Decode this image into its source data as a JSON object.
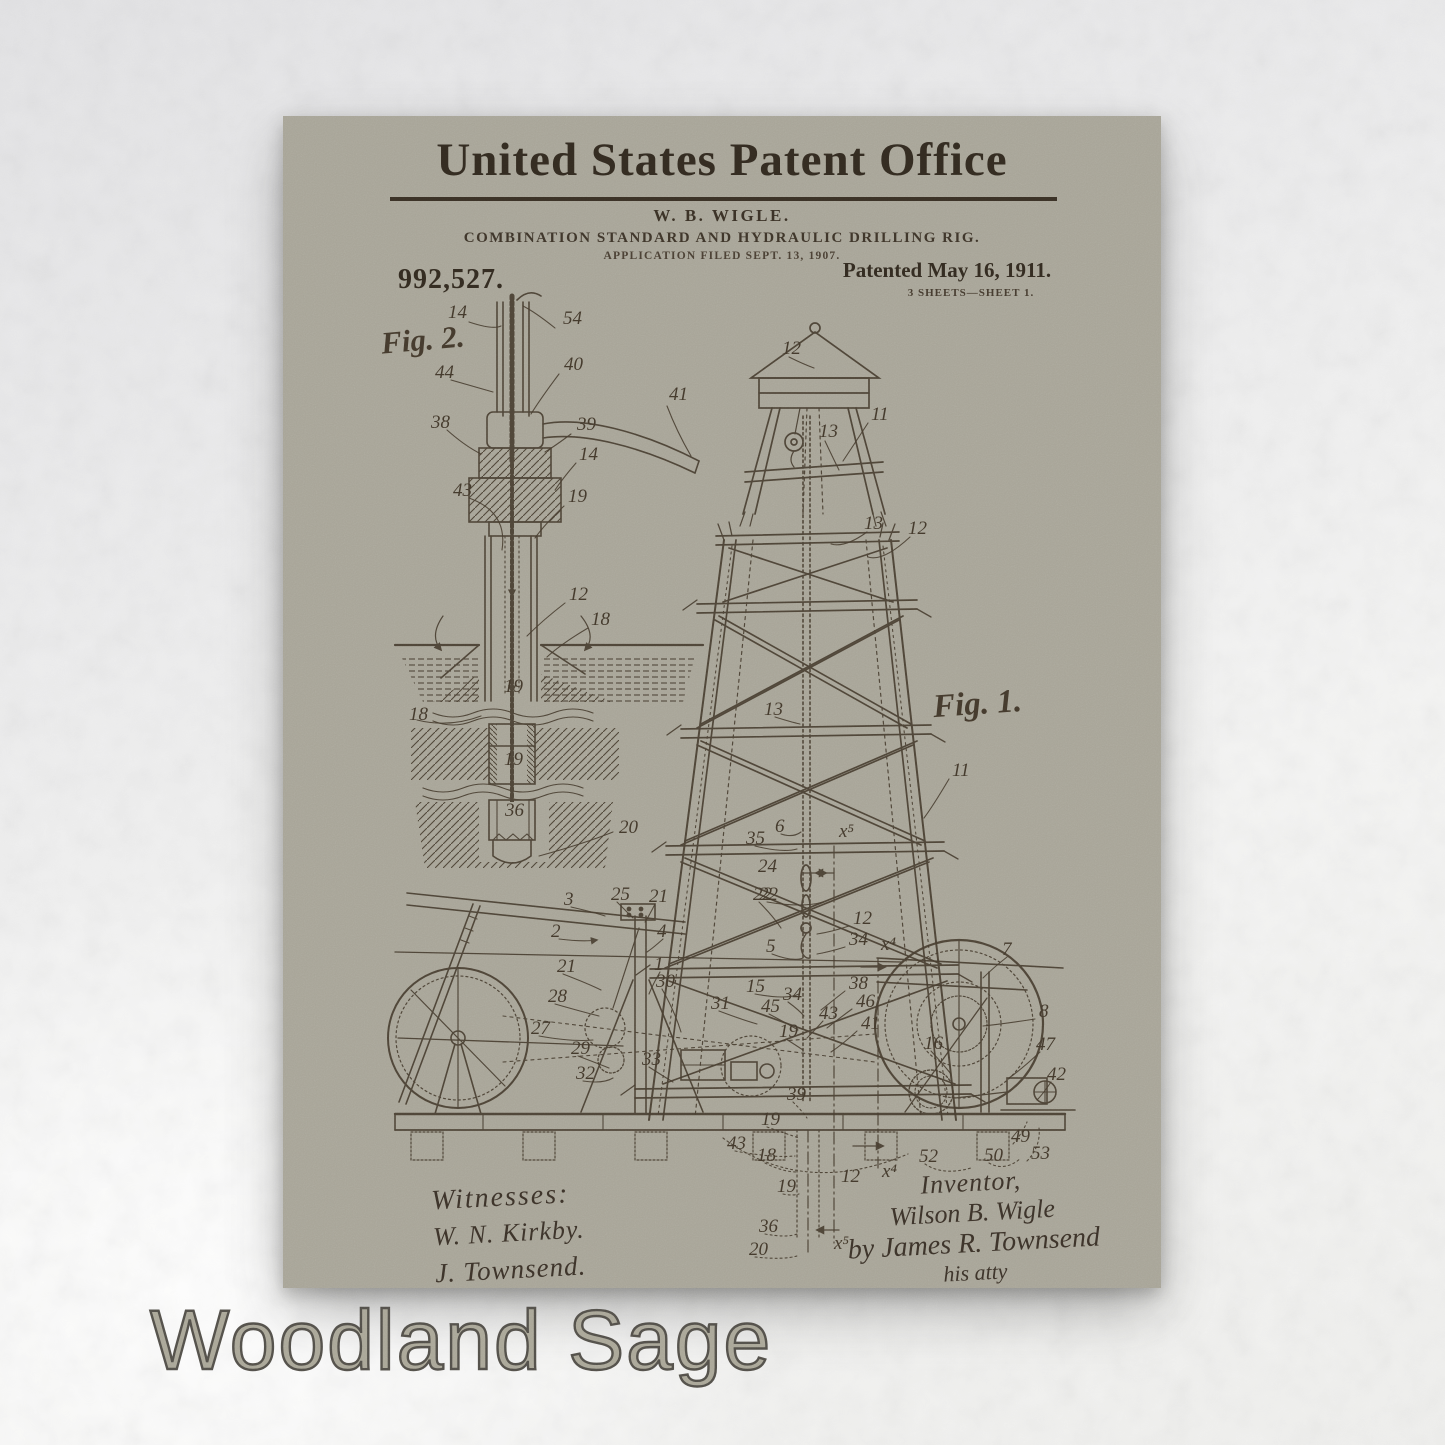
{
  "product": {
    "swatch_label": "Woodland Sage"
  },
  "colors": {
    "wall": "#efefed",
    "poster_background": "#a7a497",
    "ink": "#3a3126",
    "swatch_fill": "#a9a697",
    "swatch_outline": "#53504a"
  },
  "patent": {
    "office_title": "United States Patent Office",
    "inventor_abbrev": "W. B. WIGLE.",
    "invention_title": "COMBINATION STANDARD AND HYDRAULIC DRILLING RIG.",
    "application_line": "APPLICATION FILED SEPT. 13, 1907.",
    "patent_number": "992,527.",
    "patented_date": "Patented May 16, 1911.",
    "sheet_info": "3 SHEETS—SHEET 1.",
    "figure1_label": "Fig. 1.",
    "figure2_label": "Fig. 2."
  },
  "signatures": {
    "witnesses_heading": "Witnesses:",
    "witness1": "W. N. Kirkby.",
    "witness2": "J. Townsend.",
    "inventor_heading": "Inventor,",
    "inventor_name": "Wilson B. Wigle",
    "attorney_line": "by James R. Townsend",
    "attorney_title": "his atty"
  },
  "drawing": {
    "callouts": [
      {
        "t": "14",
        "x": 165,
        "y": 202
      },
      {
        "t": "54",
        "x": 280,
        "y": 208
      },
      {
        "t": "44",
        "x": 152,
        "y": 262
      },
      {
        "t": "40",
        "x": 281,
        "y": 254
      },
      {
        "t": "38",
        "x": 148,
        "y": 312
      },
      {
        "t": "39",
        "x": 294,
        "y": 314
      },
      {
        "t": "41",
        "x": 386,
        "y": 284
      },
      {
        "t": "14",
        "x": 296,
        "y": 344
      },
      {
        "t": "43",
        "x": 170,
        "y": 380
      },
      {
        "t": "19",
        "x": 285,
        "y": 386
      },
      {
        "t": "12",
        "x": 286,
        "y": 484
      },
      {
        "t": "18",
        "x": 308,
        "y": 509
      },
      {
        "t": "19",
        "x": 221,
        "y": 576
      },
      {
        "t": "18",
        "x": 126,
        "y": 604
      },
      {
        "t": "19",
        "x": 221,
        "y": 649
      },
      {
        "t": "36",
        "x": 222,
        "y": 700
      },
      {
        "t": "20",
        "x": 336,
        "y": 717
      },
      {
        "t": "12",
        "x": 499,
        "y": 238
      },
      {
        "t": "13",
        "x": 536,
        "y": 321
      },
      {
        "t": "11",
        "x": 588,
        "y": 304
      },
      {
        "t": "13",
        "x": 581,
        "y": 413
      },
      {
        "t": "12",
        "x": 625,
        "y": 418
      },
      {
        "t": "13",
        "x": 481,
        "y": 599
      },
      {
        "t": "11",
        "x": 669,
        "y": 660
      },
      {
        "t": "35",
        "x": 463,
        "y": 728
      },
      {
        "t": "6",
        "x": 492,
        "y": 716
      },
      {
        "t": "x⁵",
        "x": 556,
        "y": 721
      },
      {
        "t": "24",
        "x": 475,
        "y": 756
      },
      {
        "t": "22",
        "x": 476,
        "y": 784
      },
      {
        "t": "12",
        "x": 570,
        "y": 808
      },
      {
        "t": "34",
        "x": 566,
        "y": 829
      },
      {
        "t": "x⁴",
        "x": 598,
        "y": 834
      },
      {
        "t": "5",
        "x": 483,
        "y": 836
      },
      {
        "t": "15",
        "x": 463,
        "y": 876
      },
      {
        "t": "34",
        "x": 500,
        "y": 884
      },
      {
        "t": "38",
        "x": 566,
        "y": 873
      },
      {
        "t": "46",
        "x": 573,
        "y": 891
      },
      {
        "t": "45",
        "x": 478,
        "y": 896
      },
      {
        "t": "43",
        "x": 536,
        "y": 903
      },
      {
        "t": "19",
        "x": 496,
        "y": 921
      },
      {
        "t": "41",
        "x": 578,
        "y": 913
      },
      {
        "t": "31",
        "x": 428,
        "y": 893
      },
      {
        "t": "16",
        "x": 641,
        "y": 933
      },
      {
        "t": "3",
        "x": 281,
        "y": 789
      },
      {
        "t": "25",
        "x": 328,
        "y": 784
      },
      {
        "t": "21",
        "x": 366,
        "y": 786
      },
      {
        "t": "22",
        "x": 470,
        "y": 784
      },
      {
        "t": "2",
        "x": 268,
        "y": 821
      },
      {
        "t": "4",
        "x": 374,
        "y": 821
      },
      {
        "t": "1",
        "x": 371,
        "y": 854
      },
      {
        "t": "30",
        "x": 373,
        "y": 871
      },
      {
        "t": "21",
        "x": 274,
        "y": 856
      },
      {
        "t": "28",
        "x": 265,
        "y": 886
      },
      {
        "t": "27",
        "x": 248,
        "y": 918
      },
      {
        "t": "29",
        "x": 288,
        "y": 938
      },
      {
        "t": "32",
        "x": 293,
        "y": 963
      },
      {
        "t": "33",
        "x": 359,
        "y": 949
      },
      {
        "t": "7",
        "x": 719,
        "y": 839
      },
      {
        "t": "8",
        "x": 756,
        "y": 901
      },
      {
        "t": "47",
        "x": 753,
        "y": 934
      },
      {
        "t": "42",
        "x": 764,
        "y": 964
      },
      {
        "t": "39",
        "x": 504,
        "y": 984
      },
      {
        "t": "19",
        "x": 478,
        "y": 1009
      },
      {
        "t": "43",
        "x": 444,
        "y": 1033
      },
      {
        "t": "18",
        "x": 474,
        "y": 1045
      },
      {
        "t": "19",
        "x": 494,
        "y": 1076
      },
      {
        "t": "12",
        "x": 558,
        "y": 1066
      },
      {
        "t": "x⁴",
        "x": 599,
        "y": 1061
      },
      {
        "t": "52",
        "x": 636,
        "y": 1046
      },
      {
        "t": "50",
        "x": 701,
        "y": 1045
      },
      {
        "t": "53",
        "x": 748,
        "y": 1043
      },
      {
        "t": "49",
        "x": 728,
        "y": 1026
      },
      {
        "t": "36",
        "x": 476,
        "y": 1116
      },
      {
        "t": "20",
        "x": 466,
        "y": 1139
      },
      {
        "t": "x⁵",
        "x": 551,
        "y": 1133
      }
    ]
  }
}
